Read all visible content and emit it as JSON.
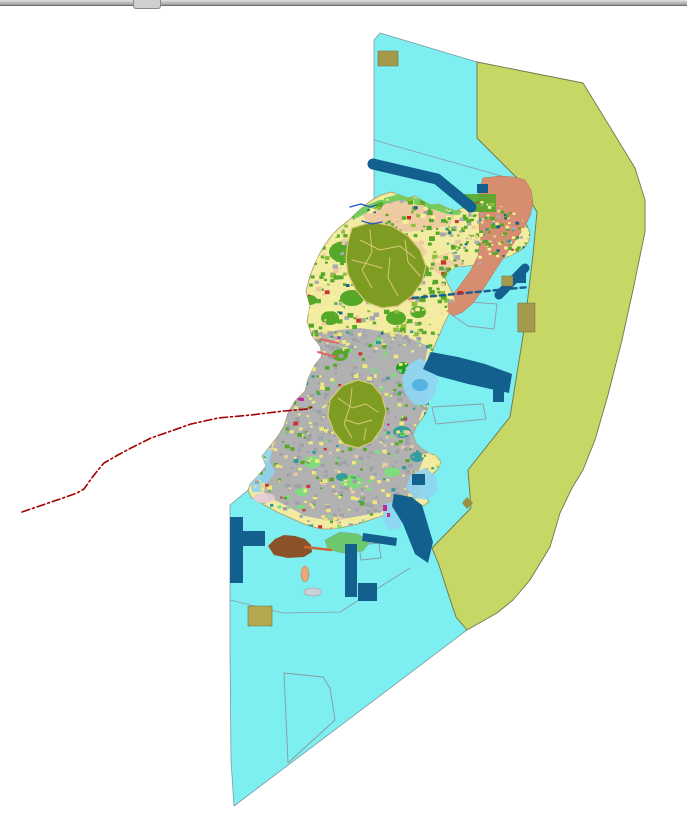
{
  "window": {
    "splitter_role": "horizontal-splitter"
  },
  "map": {
    "width": 687,
    "height": 821,
    "colors": {
      "water": "#7DEFF0",
      "zone": "#C7D766",
      "island": "#F2EBA2",
      "peach": "#EDC9A0",
      "salmon": "#D78E70",
      "green": "#55A828",
      "darkolive": "#7E9C21",
      "oliveborder": "#D9C878",
      "lightgreen": "#7EDC7E",
      "coastgreen": "#66CC55",
      "teal": "#2E9C9C",
      "gray": "#ABABB2",
      "navy": "#135F8D",
      "brown": "#8A5228",
      "khaki": "#A59A4C",
      "khaki2": "#B3A94F",
      "lightblue": "#8FD4F0",
      "deepblue": "#49AEDE",
      "redline": "#A30000",
      "river": "#2255CC",
      "outline": "#8A98A2",
      "pink": "#E0636E",
      "magenta": "#BE2A9E",
      "orange": "#CC6633",
      "lavender": "#E6CCD6"
    },
    "island_points": "355,214 364,206 372,200 381,195 391,192 400,195 408,198 415,196 423,201 431,205 439,204 447,208 456,211 466,207 476,202 486,199 495,201 505,206 514,212 521,218 527,225 530,233 529,241 524,248 516,253 507,257 497,260 487,263 477,265 467,266 456,267 449,271 445,278 449,286 453,294 455,302 451,310 447,318 443,326 440,334 436,342 433,350 430,358 426,365 420,370 414,374 419,381 424,389 427,397 429,405 426,413 421,420 416,427 413,435 416,443 422,449 429,453 436,456 441,462 438,469 432,475 425,480 419,485 421,492 426,497 429,502 421,507 412,510 403,508 394,511 385,515 376,518 367,521 358,524 349,526 340,528 331,529 322,529 313,527 304,524 295,520 286,516 277,512 268,507 259,502 251,497 248,491 250,484 258,476 266,466 262,456 270,446 278,436 284,426 288,413 295,401 305,391 308,379 314,366 322,356 320,346 312,336 307,321 310,306 306,291 310,276 315,263 320,253 326,243 333,234 340,227 348,221",
    "speckle_regions": [
      {
        "name": "speckle-north",
        "seed": 7,
        "count": 520,
        "bbox": [
          308,
          196,
          184,
          138
        ],
        "size": [
          2,
          6
        ],
        "clip": true,
        "palette": [
          [
            "#55A828",
            45
          ],
          [
            "#8FBE3C",
            10
          ],
          [
            "#EDC9A0",
            10
          ],
          [
            "#A8A8B0",
            10
          ],
          [
            "#F7F19A",
            20
          ],
          [
            "#CC3333",
            3
          ],
          [
            "#135F8D",
            2
          ]
        ]
      },
      {
        "name": "speckle-mid",
        "seed": 11,
        "count": 430,
        "bbox": [
          284,
          330,
          168,
          104
        ],
        "size": [
          2,
          5
        ],
        "clip": true,
        "palette": [
          [
            "#A0A0A8",
            36
          ],
          [
            "#F0E87C",
            30
          ],
          [
            "#55A828",
            14
          ],
          [
            "#2E9C9C",
            6
          ],
          [
            "#7EDC7E",
            10
          ],
          [
            "#CC3333",
            2
          ],
          [
            "#BE2A9E",
            2
          ]
        ]
      },
      {
        "name": "speckle-south",
        "seed": 23,
        "count": 410,
        "bbox": [
          252,
          430,
          186,
          98
        ],
        "size": [
          2,
          5
        ],
        "clip": true,
        "palette": [
          [
            "#A0A0A8",
            34
          ],
          [
            "#F0E87C",
            30
          ],
          [
            "#7EDC7E",
            12
          ],
          [
            "#55A828",
            12
          ],
          [
            "#EDC9A0",
            6
          ],
          [
            "#2E9C9C",
            4
          ],
          [
            "#CC3333",
            2
          ]
        ]
      },
      {
        "name": "speckle-ne-arm",
        "seed": 31,
        "count": 170,
        "bbox": [
          445,
          198,
          88,
          58
        ],
        "size": [
          2,
          4
        ],
        "clip": true,
        "palette": [
          [
            "#F7F19A",
            28
          ],
          [
            "#55A828",
            30
          ],
          [
            "#A8A8B0",
            14
          ],
          [
            "#135F8D",
            10
          ],
          [
            "#2E9C9C",
            8
          ],
          [
            "#CC3333",
            5
          ],
          [
            "#EDC9A0",
            5
          ]
        ]
      }
    ],
    "layers": [
      {
        "name": "sea-zone",
        "type": "poly",
        "pts": "380,33 477,62 477,138 517,178 537,212 533,255 524,330 510,417 468,470 471,508 432,548 439,565 446,587 456,617 467,630 234,806 231,760 230,650 230,505 253,486 262,478 272,450 282,436 292,410 310,390 322,360 320,340 315,322 316,300 324,270 334,245 340,232 356,218 366,212 374,202 374,140 374,40",
        "f": "#7DEFF0",
        "s": "#7A9AA2",
        "sw": 0.8
      },
      {
        "name": "buffer-zone",
        "type": "poly",
        "pts": "477,62 583,83 610,127 635,168 645,200 645,232 633,290 622,340 608,395 595,440 583,470 572,488 560,513 550,547 530,580 513,600 497,613 467,630 456,617 446,587 439,565 432,548 471,508 468,470 510,417 524,330 533,255 537,212 517,178 477,138",
        "f": "#C7D766",
        "s": "#6B7A4A",
        "sw": 0.9
      },
      {
        "name": "zone-divider-north",
        "type": "pline",
        "pts": "374,140 519,181",
        "s": "#8A98A2",
        "sw": 0.8
      },
      {
        "name": "zone-divider-south",
        "type": "pline",
        "pts": "230,600 283,613 340,612 410,568",
        "s": "#8A98A2",
        "sw": 0.8
      },
      {
        "name": "survey-outline-east",
        "type": "poly",
        "pts": "456,301 497,304 494,329 468,326 452,315",
        "s": "#90A0AA",
        "sw": 1
      },
      {
        "name": "survey-outline-harbor",
        "type": "poly",
        "pts": "432,407 483,404 486,419 436,424",
        "s": "#90A0AA",
        "sw": 1
      },
      {
        "name": "survey-outline-south",
        "type": "poly",
        "pts": "284,673 323,677 330,688 335,720 288,763",
        "s": "#8A98A2",
        "sw": 0.9
      },
      {
        "name": "survey-outline-small",
        "type": "poly",
        "pts": "359,545 379,543 381,558 361,560",
        "s": "#8A98A2",
        "sw": 0.9
      },
      {
        "name": "island-base",
        "type": "poly",
        "ref": "island_points",
        "f": "#F2EBA2",
        "s": "#A89A60",
        "sw": 0.8
      },
      {
        "name": "peach-area-1",
        "type": "poly",
        "pts": "362,215 380,203 400,198 420,203 440,208 455,214 450,225 430,230 405,232 382,228 368,222",
        "f": "#EDC9A0",
        "o": 0.95,
        "clip": true
      },
      {
        "name": "peach-area-2",
        "type": "poly",
        "pts": "372,245 395,238 418,242 428,252 415,262 390,262 375,255",
        "f": "#EDC9A0",
        "o": 0.75,
        "clip": true
      },
      {
        "name": "peach-area-3",
        "type": "poly",
        "pts": "432,258 450,252 463,260 460,272 445,278 433,270",
        "f": "#EDC9A0",
        "o": 0.8,
        "clip": true
      },
      {
        "name": "urban-gray-area",
        "type": "poly",
        "pts": "320,332 360,328 400,334 428,346 424,368 429,394 419,420 429,446 419,470 424,490 410,505 390,510 360,516 331,521 305,516 287,506 266,496 259,481 267,466 273,446 281,426 289,406 296,386 300,366 305,346",
        "f": "#ABABB2",
        "o": 0.92,
        "clip": true
      },
      {
        "name": "shallow-west",
        "type": "poly",
        "pts": "252,492 250,482 256,471 263,462 259,452 265,443 272,450 270,462 275,472 268,482 262,492",
        "f": "#8FD4F0",
        "o": 0.9,
        "clip": true
      },
      {
        "name": "salmon-district",
        "type": "poly",
        "pts": "483,178 500,176 514,177 525,180 531,190 533,203 530,216 524,228 517,238 509,250 500,263 491,277 482,291 473,303 463,312 453,316 446,310 451,297 461,284 471,270 478,256 480,241 479,226 479,207 479,192",
        "f": "#D78E70",
        "s": "#B06A50",
        "sw": 0.5
      },
      {
        "name": "coast-green-strip",
        "type": "pline",
        "pts": "356,215 370,207 385,201 400,197 412,200 424,204 436,207 448,211 458,212",
        "s": "#66CC55",
        "sw": 6,
        "o": 0.9,
        "clip": true
      },
      {
        "name": "green-rect-ne",
        "type": "rect",
        "r": [
          462,
          194,
          34,
          18
        ],
        "f": "#55A828",
        "o": 0.9
      },
      {
        "name": "forest-patches",
        "type": "ells",
        "e": [
          [
            345,
            252,
            16,
            11
          ],
          [
            372,
            268,
            13,
            9
          ],
          [
            398,
            257,
            11,
            8
          ],
          [
            420,
            270,
            9,
            7
          ],
          [
            352,
            298,
            12,
            8
          ],
          [
            330,
            318,
            9,
            7
          ],
          [
            396,
            318,
            10,
            7
          ],
          [
            418,
            312,
            8,
            6
          ],
          [
            310,
            300,
            7,
            5
          ],
          [
            340,
            355,
            8,
            6
          ]
        ],
        "f": "#55A828",
        "clip": true
      },
      {
        "name": "forest-patches-light",
        "type": "ells",
        "e": [
          [
            312,
            462,
            9,
            6
          ],
          [
            352,
            482,
            11,
            7
          ],
          [
            392,
            472,
            8,
            5
          ],
          [
            302,
            492,
            7,
            4
          ]
        ],
        "f": "#7EDC7E",
        "clip": true
      },
      {
        "name": "teal-patches",
        "type": "ells",
        "e": [
          [
            402,
            432,
            9,
            6
          ],
          [
            417,
            457,
            7,
            5
          ],
          [
            342,
            477,
            6,
            4
          ]
        ],
        "f": "#2E9C9C",
        "o": 0.95,
        "clip": true
      },
      {
        "name": "green-knoll",
        "type": "ell",
        "e": [
          403,
          368,
          7,
          6
        ],
        "f": "#1F9F1F",
        "clip": true
      },
      {
        "name": "speckle-north",
        "type": "speckles",
        "region": 0
      },
      {
        "name": "speckle-mid",
        "type": "speckles",
        "region": 1
      },
      {
        "name": "speckle-south",
        "type": "speckles",
        "region": 2
      },
      {
        "name": "speckle-ne-arm",
        "type": "speckles",
        "region": 3
      },
      {
        "name": "forest-cluster-north",
        "type": "poly",
        "pts": "352,228 372,222 392,226 408,236 420,250 426,266 422,282 412,296 398,306 382,308 366,302 356,290 348,274 346,258 348,242",
        "f": "#7E9C21",
        "s": "#D9C878",
        "sw": 1.2
      },
      {
        "name": "forest-cluster-north-parcels",
        "type": "plines",
        "p": [
          "360,240 380,250 400,246 415,258",
          "370,230 372,252 362,270 372,288",
          "390,258 388,278 398,296",
          "405,240 408,262 420,276",
          "352,260 368,264 382,268"
        ],
        "s": "#D9C878",
        "sw": 1
      },
      {
        "name": "forest-cluster-south",
        "type": "poly",
        "pts": "330,400 342,386 358,380 372,384 382,396 386,412 382,428 372,442 358,448 344,444 334,432 328,416",
        "f": "#7E9C21",
        "s": "#D9C878",
        "sw": 1.2
      },
      {
        "name": "forest-cluster-south-parcels",
        "type": "plines",
        "p": [
          "338,398 352,408 366,404 378,412",
          "346,420 358,424 372,420",
          "352,388 350,406 344,424 352,438",
          "366,428 364,440"
        ],
        "s": "#D9C878",
        "sw": 1
      },
      {
        "name": "bay-east",
        "type": "poly",
        "pts": "408,365 420,358 432,366 438,380 434,396 425,406 413,404 404,392 402,378",
        "f": "#8FD4F0",
        "o": 0.95
      },
      {
        "name": "bay-east-deep",
        "type": "ell",
        "e": [
          420,
          385,
          8,
          6
        ],
        "f": "#49AEDE",
        "o": 0.85
      },
      {
        "name": "bay-southeast",
        "type": "poly",
        "pts": "410,476 425,468 436,476 438,490 428,500 414,498 406,488",
        "f": "#8FD4F0",
        "o": 0.9
      },
      {
        "name": "inlet-south",
        "type": "poly",
        "pts": "385,504 398,500 404,512 400,528 388,530 382,518",
        "f": "#8FD4F0",
        "o": 0.9
      },
      {
        "name": "peninsula-south",
        "type": "poly",
        "pts": "325,540 340,532 358,534 370,542 363,551 342,553 328,549",
        "f": "#6CC86C",
        "s": "#8A98A2",
        "sw": 0.5
      },
      {
        "name": "port-band-north",
        "type": "pline",
        "pts": "373,164 437,179 471,207",
        "s": "#135F8D",
        "sw": 11
      },
      {
        "name": "port-rect-ne",
        "type": "rect",
        "r": [
          477,
          184,
          11,
          9
        ],
        "f": "#135F8D"
      },
      {
        "name": "port-band-ne",
        "type": "pline",
        "pts": "525,268 499,295",
        "s": "#135F8D",
        "sw": 9
      },
      {
        "name": "breakwater-dashes",
        "type": "pline",
        "pts": "413,298 529,287",
        "s": "#1A6090",
        "sw": 2.5,
        "d": "5 4"
      },
      {
        "name": "khaki-plot-east-1",
        "type": "rect",
        "r": [
          502,
          276,
          11,
          10
        ],
        "f": "#A59A4C",
        "s": "#6A6A40",
        "sw": 0.5
      },
      {
        "name": "port-rect-east",
        "type": "rect",
        "r": [
          516,
          272,
          10,
          11
        ],
        "f": "#135F8D"
      },
      {
        "name": "khaki-plot-east-2",
        "type": "rect",
        "r": [
          518,
          303,
          17,
          29
        ],
        "f": "#A59A4C",
        "s": "#6A6A40",
        "sw": 0.5
      },
      {
        "name": "harbor-basin",
        "type": "poly",
        "pts": "431,352 458,357 485,364 512,374 509,393 468,384 438,376 423,369",
        "f": "#135F8D"
      },
      {
        "name": "port-rect-se",
        "type": "rect",
        "r": [
          493,
          389,
          11,
          13
        ],
        "f": "#135F8D"
      },
      {
        "name": "port-wedge-se",
        "type": "poly",
        "pts": "394,494 411,497 422,505 433,542 428,563 415,554 403,524 392,506",
        "f": "#135F8D"
      },
      {
        "name": "port-strip-south",
        "type": "poly",
        "pts": "363,533 397,538 396,546 362,541",
        "f": "#135F8D"
      },
      {
        "name": "port-rect-small",
        "type": "rect",
        "r": [
          412,
          474,
          13,
          11
        ],
        "f": "#135F8D"
      },
      {
        "name": "port-bar-west",
        "type": "rect",
        "r": [
          230,
          517,
          13,
          66
        ],
        "f": "#135F8D"
      },
      {
        "name": "port-bar-west-arm",
        "type": "rect",
        "r": [
          243,
          531,
          22,
          15
        ],
        "f": "#135F8D"
      },
      {
        "name": "port-bar-center",
        "type": "rect",
        "r": [
          345,
          544,
          12,
          53
        ],
        "f": "#135F8D"
      },
      {
        "name": "port-square-center",
        "type": "rect",
        "r": [
          358,
          583,
          19,
          18
        ],
        "f": "#135F8D"
      },
      {
        "name": "brown-headland",
        "type": "poly",
        "pts": "268,546 275,539 284,535 295,536 305,539 311,545 312,552 304,557 288,558 274,555",
        "f": "#8A5228"
      },
      {
        "name": "orange-strip",
        "type": "pline",
        "pts": "305,547 331,550",
        "s": "#CC6633",
        "sw": 2.5
      },
      {
        "name": "khaki-plot-south",
        "type": "rect",
        "r": [
          248,
          606,
          24,
          20
        ],
        "f": "#B3A94F",
        "s": "#6A6A40",
        "sw": 0.6
      },
      {
        "name": "khaki-dot-se",
        "type": "poly",
        "pts": "462,503 467,497 473,503 467,509",
        "f": "#9A8F3F"
      },
      {
        "name": "khaki-plot-north",
        "type": "rect",
        "r": [
          378,
          51,
          20,
          15
        ],
        "f": "#A59A4C",
        "s": "#6A6A40",
        "sw": 0.6
      },
      {
        "name": "lavender-patch",
        "type": "ell",
        "e": [
          264,
          498,
          11,
          5
        ],
        "f": "#E6CCD6",
        "o": 0.9
      },
      {
        "name": "peach-islet",
        "type": "ell",
        "e": [
          305,
          574,
          4,
          8
        ],
        "f": "#E8A87C",
        "s": "#B07848",
        "sw": 0.5
      },
      {
        "name": "gray-islet",
        "type": "ell",
        "e": [
          313,
          592,
          9,
          4
        ],
        "f": "#CCD0D8",
        "s": "#99A0A8",
        "sw": 0.6
      },
      {
        "name": "stream-1",
        "type": "pline",
        "pts": "350,207 361,204 370,207 376,205",
        "s": "#2255CC",
        "sw": 1.4
      },
      {
        "name": "stream-2",
        "type": "pline",
        "pts": "362,221 372,224 382,222",
        "s": "#2255CC",
        "sw": 1.4
      },
      {
        "name": "pink-road-1",
        "type": "pline",
        "pts": "320,339 338,343",
        "s": "#E0636E",
        "sw": 2
      },
      {
        "name": "pink-road-2",
        "type": "pline",
        "pts": "318,352 336,357",
        "s": "#E0636E",
        "sw": 2
      },
      {
        "name": "magenta-mark-1",
        "type": "rect",
        "r": [
          383,
          505,
          4,
          6
        ],
        "f": "#BE2A9E"
      },
      {
        "name": "magenta-mark-2",
        "type": "rect",
        "r": [
          387,
          513,
          3,
          4
        ],
        "f": "#BE2A9E"
      },
      {
        "name": "red-mark-1",
        "type": "rect",
        "r": [
          458,
          291,
          5,
          3
        ],
        "f": "#CC2222"
      },
      {
        "name": "red-mark-2",
        "type": "rect",
        "r": [
          407,
          216,
          4,
          3
        ],
        "f": "#CC2222"
      },
      {
        "name": "boundary-dashed-line",
        "type": "pline",
        "pts": "22,512 63,498 77,493 84,489 91,479 98,470 104,463 118,455 131,448 151,438 174,430 191,424 218,418 251,415 284,411 308,409 312,407",
        "s": "#A30000",
        "sw": 1.6,
        "d": "8 3 2 3"
      }
    ]
  }
}
